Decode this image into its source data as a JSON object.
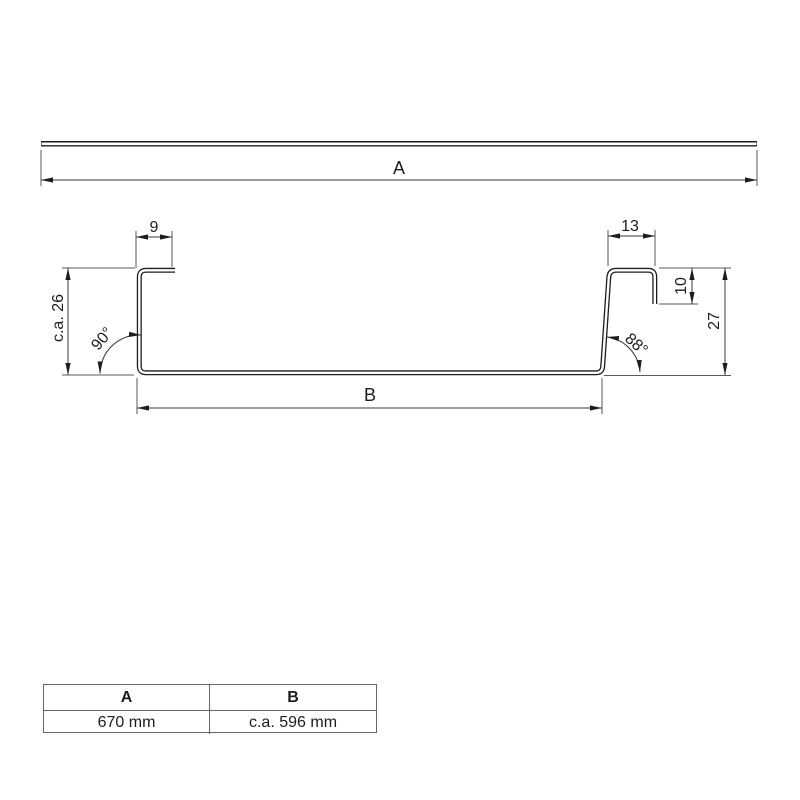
{
  "page": {
    "background": "#ffffff"
  },
  "colors": {
    "profile_line": "#1d1d1d",
    "dimension_line": "#3a3a3a",
    "extension_line": "#5a5a5a",
    "text": "#1d1d1d",
    "table_border": "#666666"
  },
  "flat_profile": {
    "width_label": "A"
  },
  "cross_section": {
    "top_left_flange": "9",
    "top_right_flange": "13",
    "right_lip": "10",
    "left_height": "c.a. 26",
    "right_height": "27",
    "left_angle": "90°",
    "right_angle": "88°",
    "web_label": "B"
  },
  "table": {
    "headers": [
      "A",
      "B"
    ],
    "values": [
      "670 mm",
      "c.a. 596 mm"
    ]
  }
}
